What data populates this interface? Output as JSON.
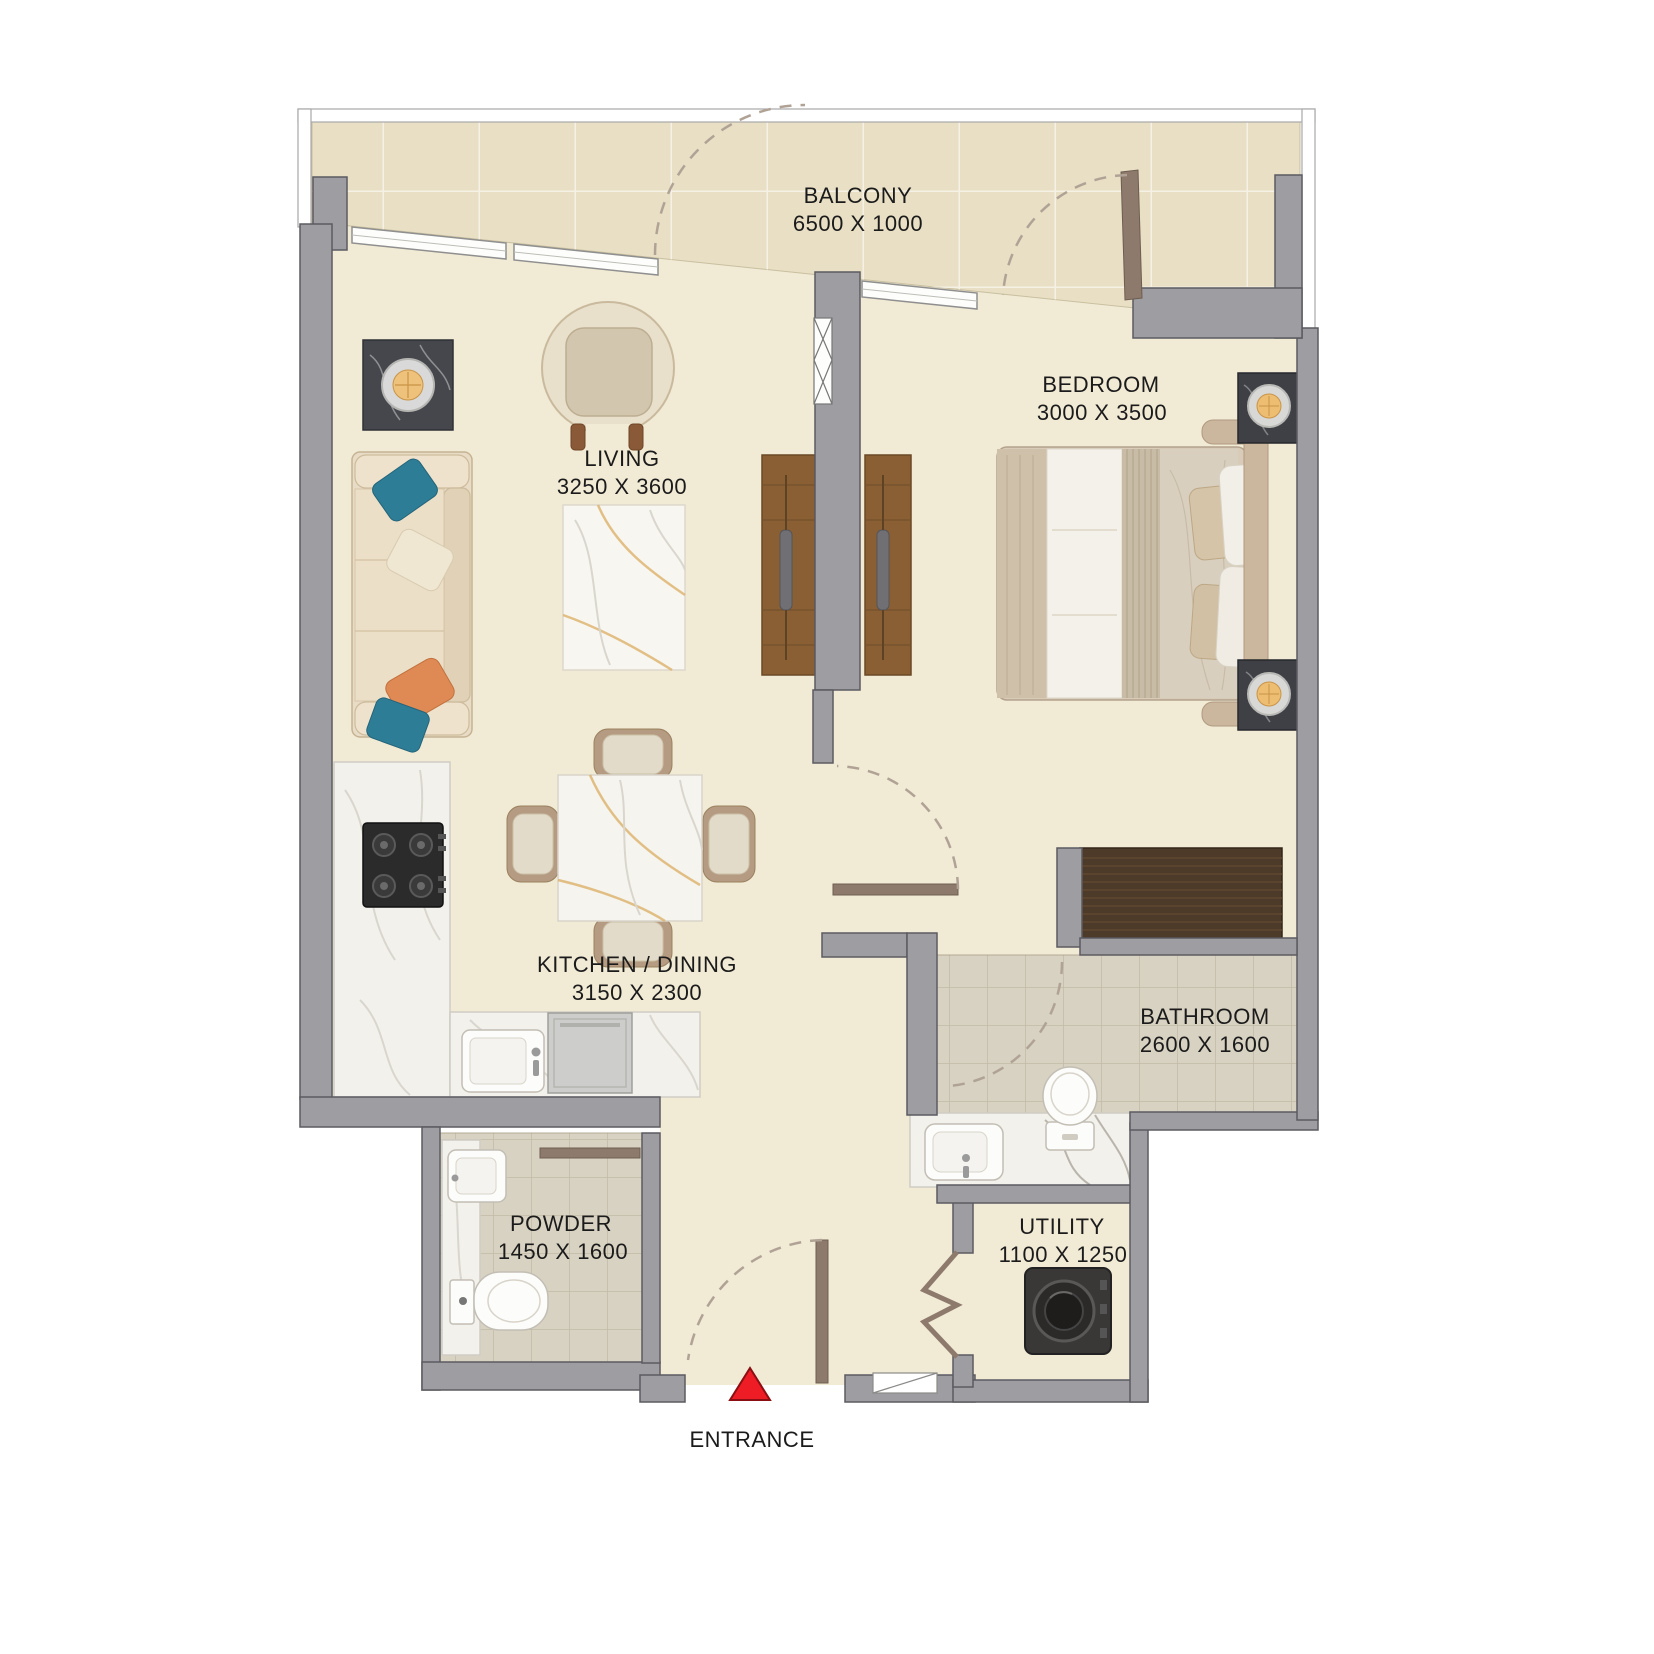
{
  "plan": {
    "rooms": {
      "balcony": {
        "name": "BALCONY",
        "dims": "6500 X 1000"
      },
      "living": {
        "name": "LIVING",
        "dims": "3250 X 3600"
      },
      "bedroom": {
        "name": "BEDROOM",
        "dims": "3000 X 3500"
      },
      "kitchen_dining": {
        "name": "KITCHEN / DINING",
        "dims": "3150 X 2300"
      },
      "bathroom": {
        "name": "BATHROOM",
        "dims": "2600 X 1600"
      },
      "powder": {
        "name": "POWDER",
        "dims": "1450 X 1600"
      },
      "utility": {
        "name": "UTILITY",
        "dims": "1100 X 1250"
      }
    },
    "entrance_label": "ENTRANCE",
    "palette": {
      "floor": "#f1ead5",
      "balcony_tile": "#e8dfc4",
      "wet_tile": "#d8d2c2",
      "wall": "#9d9da2",
      "wood_unit": "#8a5f33",
      "wardrobe": "#4e3a28",
      "door": "#8d7a6c",
      "entrance_marker_red": "#ee1c25",
      "label_text": "#1b1b1b"
    }
  }
}
